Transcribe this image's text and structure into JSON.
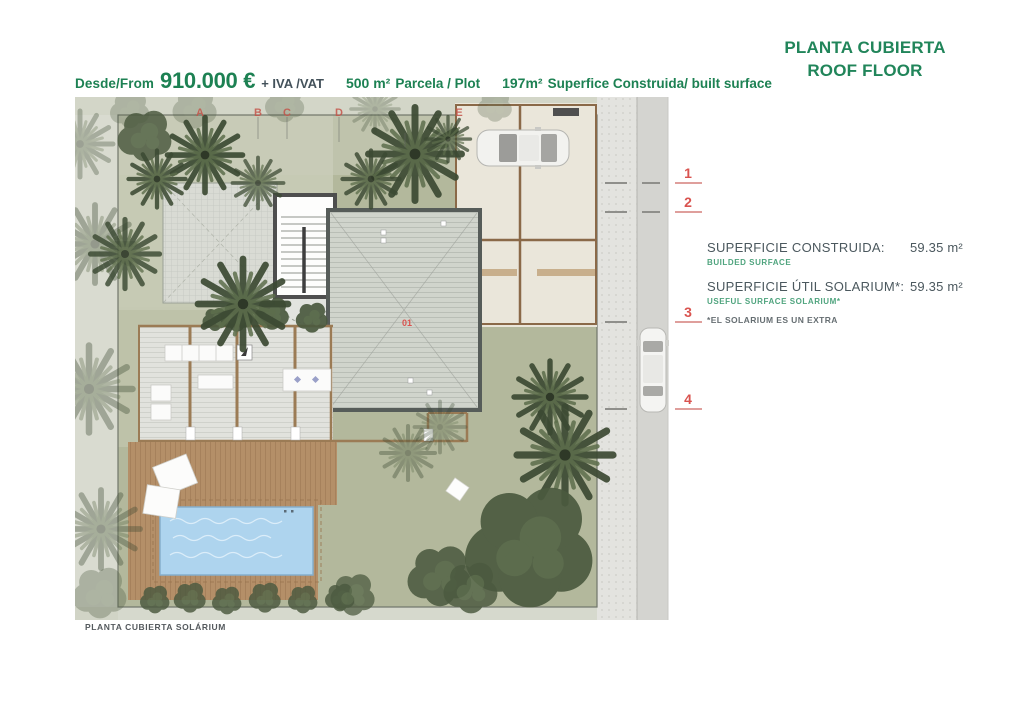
{
  "header": {
    "price": {
      "from_label": "Desde/From",
      "amount": "910.000 €",
      "vat_label": "+ IVA /VAT",
      "plot_value": "500 m²",
      "plot_label": "Parcela / Plot",
      "built_value": "197m²",
      "built_label": "Superfice Construida/ built surface"
    },
    "title_line1": "PLANTA CUBIERTA",
    "title_line2": "ROOF FLOOR"
  },
  "plan": {
    "grid_letters": [
      "A",
      "B",
      "C",
      "D",
      "E"
    ],
    "markers": [
      "1",
      "2",
      "3",
      "4"
    ],
    "unit_label": "01",
    "caption": "PLANTA CUBIERTA SOLÁRIUM"
  },
  "specs": {
    "rows": [
      {
        "label": "SUPERFICIE CONSTRUIDA:",
        "sublabel": "BUILDED SURFACE",
        "value": "59.35 m²"
      },
      {
        "label": "SUPERFICIE ÚTIL SOLARIUM*:",
        "sublabel": "USEFUL SURFACE SOLARIUM*",
        "value": "59.35 m²"
      }
    ],
    "note": "*EL SOLARIUM ES UN EXTRA"
  },
  "colors": {
    "brand_green": "#1d8153",
    "sub_green": "#4fa47e",
    "marker_red": "#d9534f",
    "text_dark": "#4b585e",
    "lawn_green": "#b3b89c",
    "pool_blue": "#aed4ee",
    "deck_brown": "#b48f68",
    "roof_gray": "#d0d4cc"
  }
}
